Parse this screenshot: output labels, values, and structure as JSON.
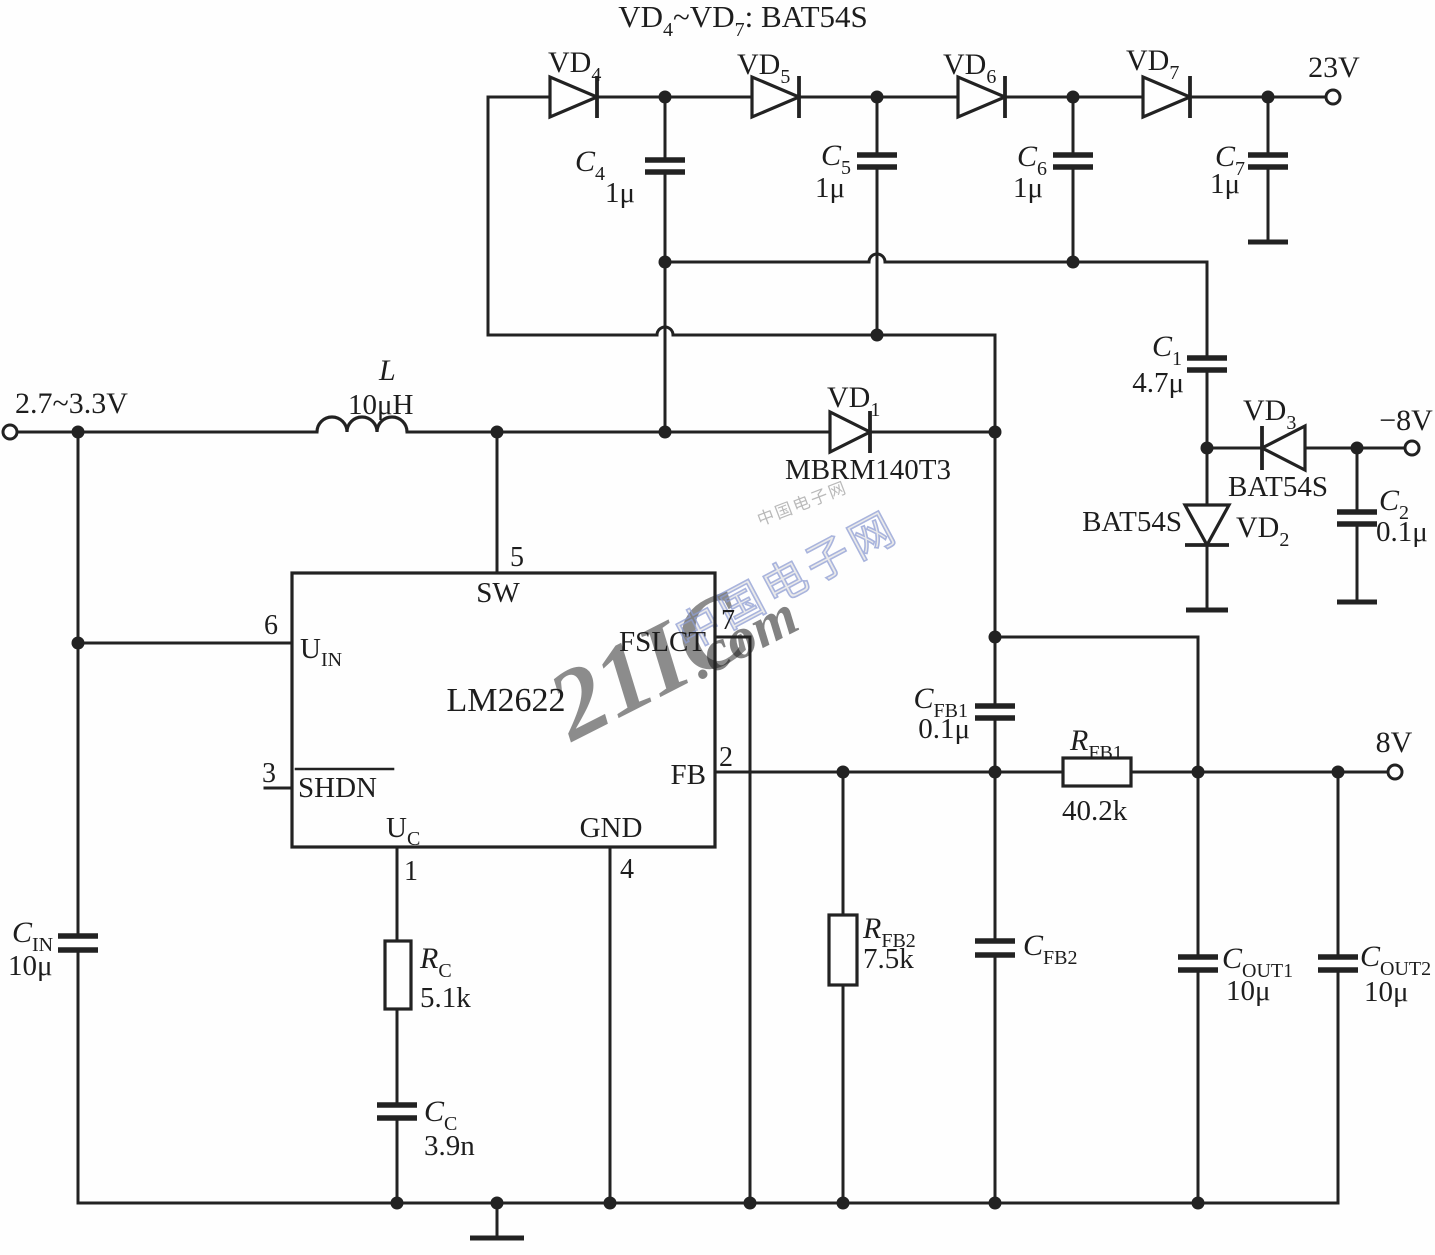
{
  "title": {
    "p1": "VD",
    "s1": "4",
    "p2": "~VD",
    "s2": "7",
    "p3": ": BAT54S"
  },
  "terminals": {
    "input": "2.7~3.3V",
    "v23": "23V",
    "v8": "8V",
    "vneg8": "−8V"
  },
  "ic": {
    "part": "LM2622",
    "pin_sw": {
      "num": "5",
      "name": "SW"
    },
    "pin_uin": {
      "num": "6",
      "main": "U",
      "sub": "IN"
    },
    "pin_shdn": {
      "num": "3",
      "name": "SHDN"
    },
    "pin_fslct": {
      "num": "7",
      "name": "FSLCT"
    },
    "pin_fb": {
      "num": "2",
      "name": "FB"
    },
    "pin_uc": {
      "num": "1",
      "main": "U",
      "sub": "C"
    },
    "pin_gnd": {
      "num": "4",
      "name": "GND"
    }
  },
  "components": {
    "l1": {
      "name": "L",
      "value": "10μH"
    },
    "vd1": {
      "main": "VD",
      "sub": "1",
      "part": "MBRM140T3"
    },
    "vd2": {
      "main": "VD",
      "sub": "2",
      "part": "BAT54S"
    },
    "vd3": {
      "main": "VD",
      "sub": "3",
      "part": "BAT54S"
    },
    "vd4": {
      "main": "VD",
      "sub": "4"
    },
    "vd5": {
      "main": "VD",
      "sub": "5"
    },
    "vd6": {
      "main": "VD",
      "sub": "6"
    },
    "vd7": {
      "main": "VD",
      "sub": "7"
    },
    "c1": {
      "main": "C",
      "sub": "1",
      "value": "4.7μ"
    },
    "c2": {
      "main": "C",
      "sub": "2",
      "value": "0.1μ"
    },
    "c4": {
      "main": "C",
      "sub": "4",
      "value": "1μ"
    },
    "c5": {
      "main": "C",
      "sub": "5",
      "value": "1μ"
    },
    "c6": {
      "main": "C",
      "sub": "6",
      "value": "1μ"
    },
    "c7": {
      "main": "C",
      "sub": "7",
      "value": "1μ"
    },
    "cin": {
      "main": "C",
      "sub": "IN",
      "value": "10μ"
    },
    "cout1": {
      "main": "C",
      "sub": "OUT1",
      "value": "10μ"
    },
    "cout2": {
      "main": "C",
      "sub": "OUT2",
      "value": "10μ"
    },
    "cfb1": {
      "main": "C",
      "sub": "FB1",
      "value": "0.1μ"
    },
    "cfb2": {
      "main": "C",
      "sub": "FB2"
    },
    "cc": {
      "main": "C",
      "sub": "C",
      "value": "3.9n"
    },
    "rc": {
      "main": "R",
      "sub": "C",
      "value": "5.1k"
    },
    "rfb1": {
      "main": "R",
      "sub": "FB1",
      "value": "40.2k"
    },
    "rfb2": {
      "main": "R",
      "sub": "FB2",
      "value": "7.5k"
    }
  },
  "watermark": {
    "cn": "中国电子网",
    "brand": "21IC",
    "tld": ".com"
  },
  "colors": {
    "line": "#222222",
    "wm_pink": "#ee9fb0",
    "wm_blue": "#8d9cd2",
    "wm_gray": "#9aa0a8"
  }
}
